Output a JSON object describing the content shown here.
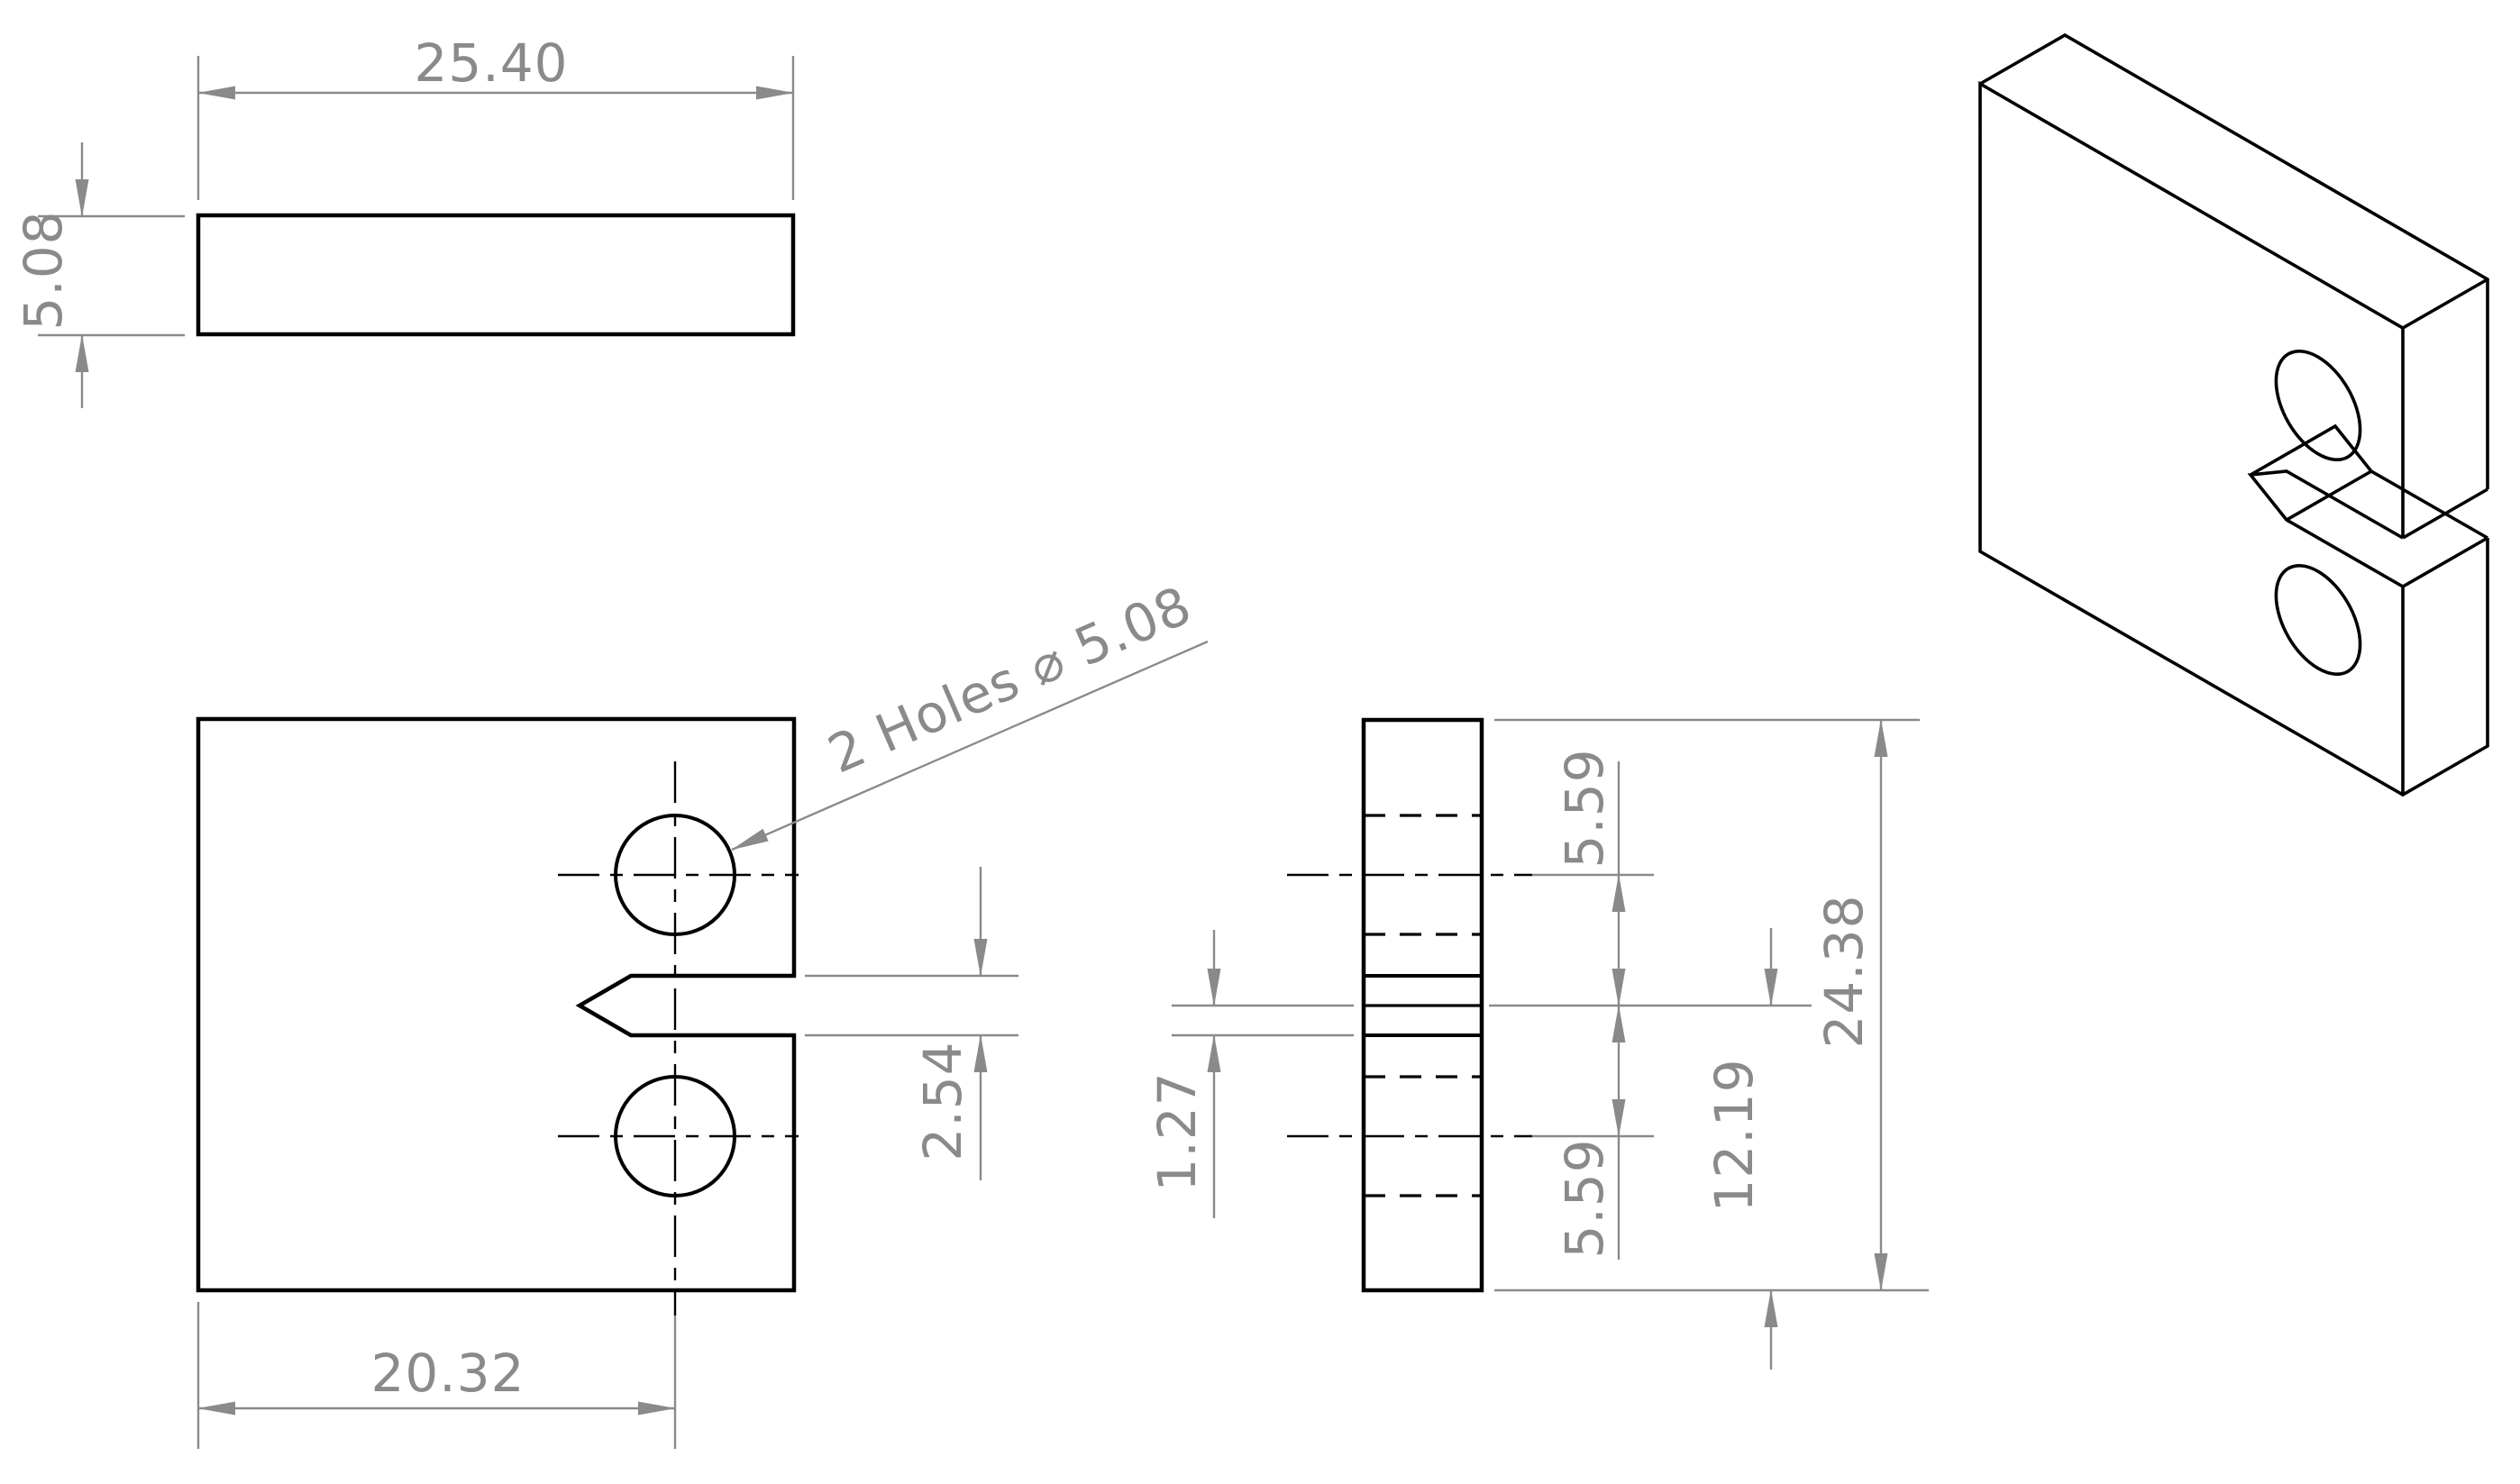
{
  "drawing": {
    "type": "engineering-drawing",
    "background_color": "#ffffff",
    "edge_color": "#000000",
    "dimension_color": "#8a8a8a",
    "views": {
      "top": {
        "title": "top-view",
        "width_dim": "25.40",
        "thickness_dim": "5.08"
      },
      "front": {
        "title": "front-view",
        "hole_note": "2 Holes ⌀ 5.08",
        "hole_offset_dim": "20.32",
        "notch_height_dim": "2.54"
      },
      "side": {
        "title": "side-view",
        "hole_to_notch_upper_dim": "5.59",
        "hole_to_notch_lower_dim": "5.59",
        "notch_half_dim": "1.27",
        "notch_center_to_bottom_dim": "12.19",
        "overall_height_dim": "24.38"
      },
      "isometric": {
        "title": "isometric-view"
      }
    }
  }
}
